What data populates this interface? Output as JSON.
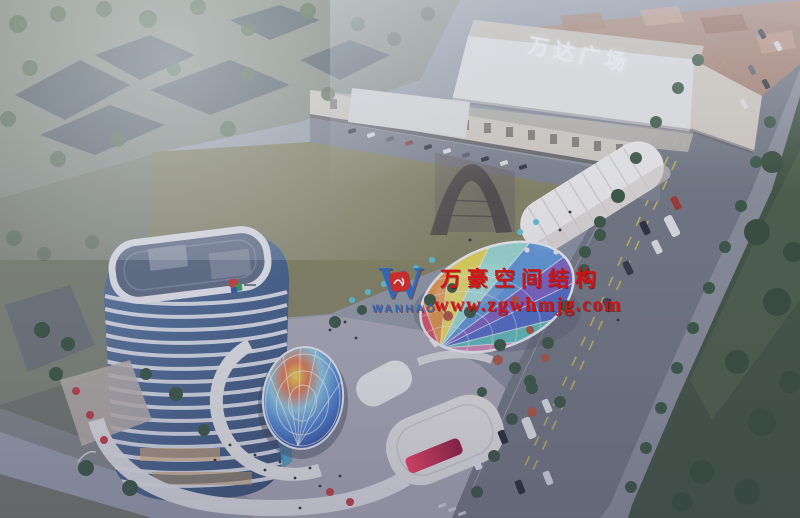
{
  "signs": {
    "mall_plaza": "万达广场"
  },
  "watermark": {
    "logo_letter": "W",
    "logo_word": "WANHAO",
    "company": "万豪空间结构",
    "website": "www.zgwhmjg.com",
    "text_color": "#d01414",
    "logo_blue": "#2a6bc4",
    "badge_red": "#d42a2a"
  },
  "palette": {
    "haze_top": "#b4bac0",
    "dusk_bottom": "#6e7688",
    "field": "#84845e",
    "road": "#70767f",
    "sidewalk": "#8b9099",
    "park": "#3c4f38",
    "plaza": "#aeadb8",
    "mall_facade": "#e9eae6",
    "shop_row": "#d8d2c4",
    "tower_band": "#edf1f5",
    "roof_deck": "#5e6e84",
    "lane_yellow": "#d8c048",
    "red_screen": "#e0244a",
    "tree_green": "#33523a",
    "tree_autumn": "#b05238",
    "umbrella_red": "#c23b3b",
    "umbrella_cyan": "#57c8d8"
  }
}
